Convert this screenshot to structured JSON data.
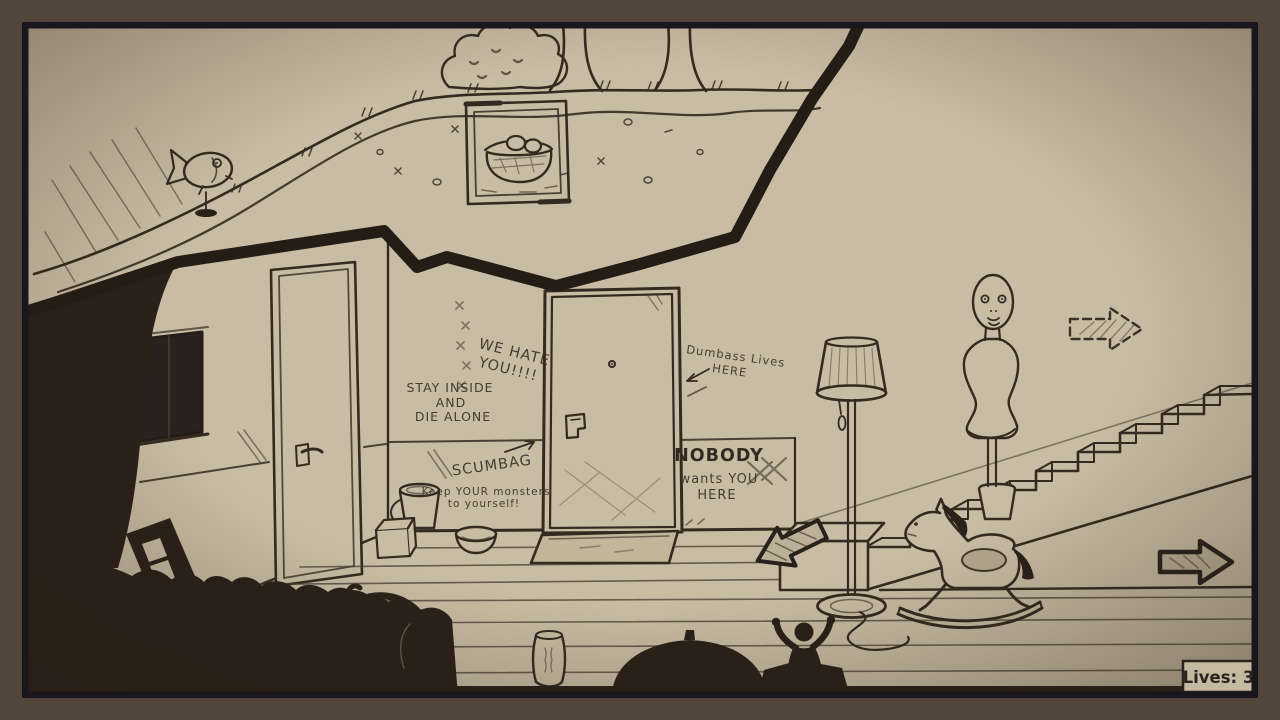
{
  "palette": {
    "paper": "#c9bca4",
    "ink": "#342a20",
    "silhouette": "#2a2119",
    "frame_outer": "#52463c",
    "frame_inner": "#17171d",
    "hud_box": "#c6b9a1",
    "arrow_fill": "#bdb098"
  },
  "graffiti": {
    "we_hate": {
      "line1": "WE HATE",
      "line2": "YOU!!!!"
    },
    "stay_inside": {
      "line1": "STAY INSIDE",
      "line2": "AND",
      "line3": "DIE ALONE"
    },
    "scumbag": {
      "label": "SCUMBAG"
    },
    "monsters": {
      "line1": "Keep YOUR monsters",
      "line2": "to yourself!"
    },
    "dumbass": {
      "line1": "Dumbass Lives",
      "line2": "HERE"
    },
    "nobody": {
      "line1": "NOBODY",
      "line2": "wants YOU",
      "line3": "HERE"
    }
  },
  "hud": {
    "lives": "Lives: 3"
  },
  "icons": {
    "exit_right": "solid-right-arrow",
    "exit_upper_right": "dashed-right-arrow",
    "stairs_base": "down-left-arrow",
    "scumbag_pointer": "up-right-arrow",
    "dumbass_pointer": "left-chevron-arrow"
  }
}
